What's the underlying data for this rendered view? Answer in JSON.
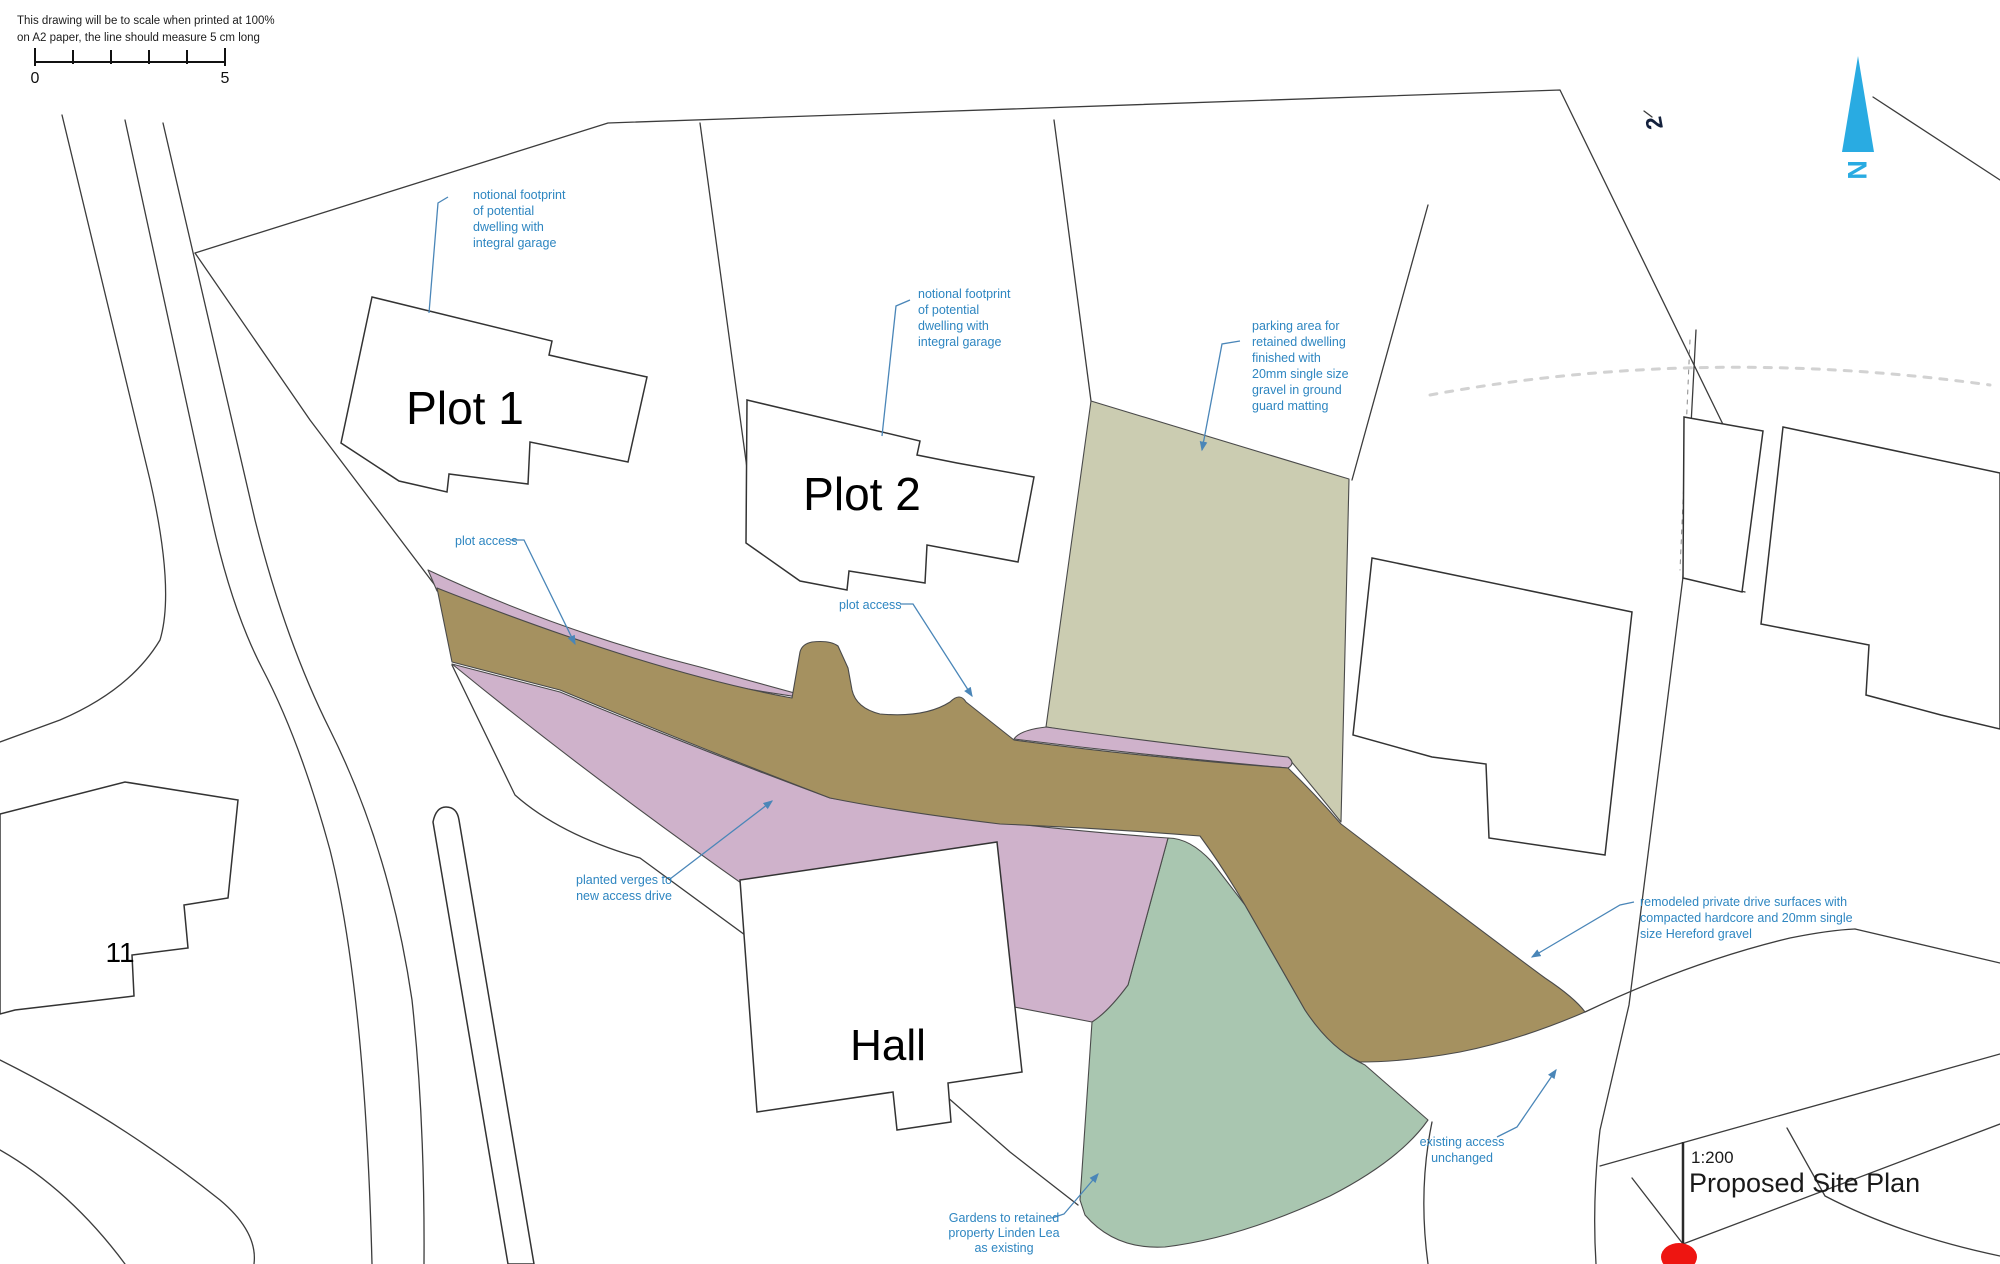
{
  "drawing": {
    "scale_note_line1": "This drawing will be to scale when printed at 100%",
    "scale_note_line2": "on A2 paper, the line should measure 5 cm long",
    "scale_start": "0",
    "scale_end": "5"
  },
  "north": {
    "label": "N"
  },
  "labels": {
    "plot1": "Plot 1",
    "plot2": "Plot 2",
    "hall": "Hall",
    "house11": "11",
    "house12": "2"
  },
  "title_block": {
    "scale": "1:200",
    "title": "Proposed Site Plan"
  },
  "notes": {
    "plot1_footprint": {
      "lines": [
        "notional footprint",
        "of potential",
        "dwelling with",
        "integral garage"
      ]
    },
    "plot2_footprint": {
      "lines": [
        "notional footprint",
        "of potential",
        "dwelling with",
        "integral garage"
      ]
    },
    "parking": {
      "lines": [
        "parking area for",
        "retained dwelling",
        "finished with",
        "20mm single size",
        "gravel in ground",
        "guard matting"
      ]
    },
    "plot_access_1": {
      "text": "plot access"
    },
    "plot_access_2": {
      "text": "plot access"
    },
    "verges": {
      "lines": [
        "planted verges to",
        "new access drive"
      ]
    },
    "remodeled": {
      "lines": [
        "remodeled private drive surfaces with",
        "compacted hardcore and 20mm single",
        "size Hereford gravel"
      ]
    },
    "existing_access": {
      "lines": [
        "existing access",
        "unchanged"
      ]
    },
    "gardens": {
      "lines": [
        "Gardens to retained",
        "property Linden Lea",
        "as existing"
      ]
    }
  },
  "colors": {
    "drive": "#a59160",
    "verge": "#cfb2cb",
    "garden": "#a9c6b0",
    "parking": "#cbccb1",
    "annotation": "#2e86c1",
    "leader": "#4a86b8",
    "north": "#29abe2",
    "marker": "#ee1511",
    "ink": "#3c3c3c"
  }
}
